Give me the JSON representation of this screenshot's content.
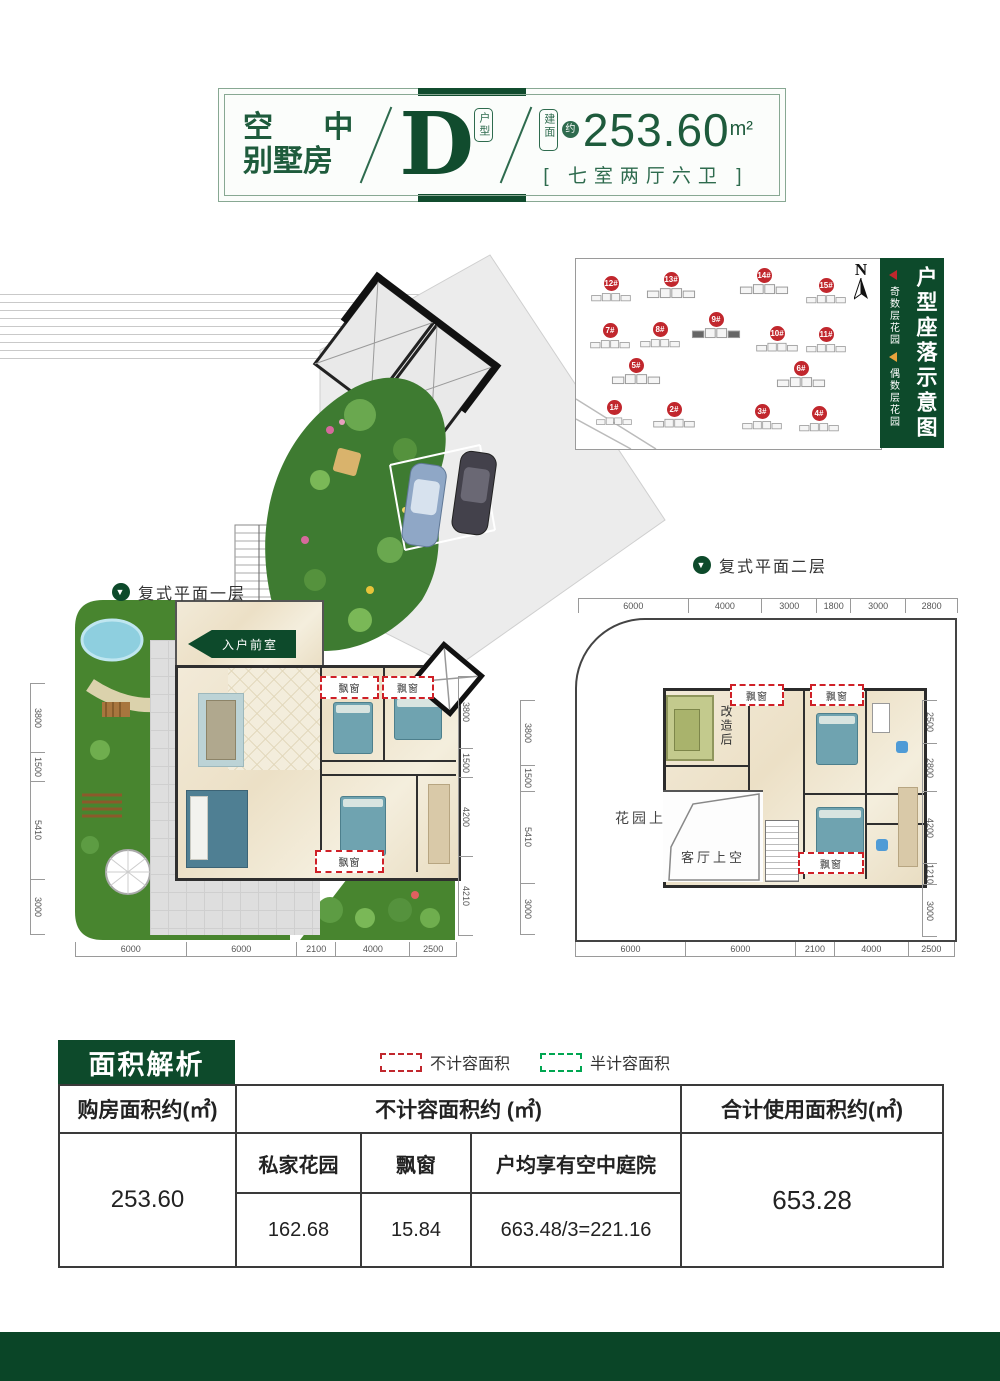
{
  "header": {
    "title_line1": "空 中",
    "title_line2": "别墅房",
    "type_letter": "D",
    "type_badge": "户型",
    "area_badge": "建面",
    "area_approx": "约",
    "area_value": "253.60",
    "area_unit": "m²",
    "layout_text": "[ 七室两厅六卫 ]"
  },
  "site_map": {
    "title": "户型座落示意图",
    "compass": "N",
    "legend_odd": "奇数层花园",
    "legend_even": "偶数层花园",
    "odd_color": "#c1272d",
    "even_color": "#e8a33d",
    "buildings": [
      {
        "id": "12#",
        "x": 35,
        "y": 22,
        "w": 40
      },
      {
        "id": "13#",
        "x": 95,
        "y": 18,
        "w": 58
      },
      {
        "id": "14#",
        "x": 188,
        "y": 14,
        "w": 58
      },
      {
        "id": "15#",
        "x": 250,
        "y": 24,
        "w": 40
      },
      {
        "id": "7#",
        "x": 34,
        "y": 69,
        "w": 40
      },
      {
        "id": "8#",
        "x": 84,
        "y": 68,
        "w": 40
      },
      {
        "id": "9#",
        "x": 140,
        "y": 58,
        "w": 52
      },
      {
        "id": "10#",
        "x": 201,
        "y": 72,
        "w": 42
      },
      {
        "id": "11#",
        "x": 250,
        "y": 73,
        "w": 40
      },
      {
        "id": "5#",
        "x": 60,
        "y": 104,
        "w": 60
      },
      {
        "id": "6#",
        "x": 225,
        "y": 107,
        "w": 58
      },
      {
        "id": "1#",
        "x": 38,
        "y": 146,
        "w": 36
      },
      {
        "id": "2#",
        "x": 98,
        "y": 148,
        "w": 42
      },
      {
        "id": "3#",
        "x": 186,
        "y": 150,
        "w": 40
      },
      {
        "id": "4#",
        "x": 243,
        "y": 152,
        "w": 40
      }
    ]
  },
  "floor1": {
    "label": "复式平面一层",
    "entry_label": "入户前室",
    "bay_window": "飘窗",
    "dims_left": [
      "3800",
      "1500",
      "5410",
      "3000"
    ],
    "dims_right": [
      "3800",
      "1500",
      "4200",
      "4210"
    ],
    "dims_bottom": [
      "6000",
      "6000",
      "2100",
      "4000",
      "2500"
    ]
  },
  "floor2": {
    "label": "复式平面二层",
    "garden_void": "花园上空",
    "living_void": "客厅上空",
    "renovated": "改造后",
    "bay_window": "飘窗",
    "dims_top": [
      "6000",
      "4000",
      "3000",
      "1800",
      "3000",
      "2800"
    ],
    "dims_left": [
      "3800",
      "1500",
      "5410",
      "3000"
    ],
    "dims_right": [
      "2500",
      "2800",
      "4200",
      "1210",
      "3000"
    ],
    "dims_bottom": [
      "6000",
      "6000",
      "2100",
      "4000",
      "2500"
    ]
  },
  "area_table": {
    "title": "面积解析",
    "legend_nojirong": "不计容面积",
    "legend_banjirong": "半计容面积",
    "nojirong_color": "#c1272d",
    "banjirong_color": "#00a651",
    "header_purchase": "购房面积约(㎡)",
    "header_nojirong": "不计容面积约 (㎡)",
    "header_total": "合计使用面积约(㎡)",
    "purchase_value": "253.60",
    "sub_headers": [
      "私家花园",
      "飘窗",
      "户均享有空中庭院"
    ],
    "sub_values": [
      "162.68",
      "15.84",
      "663.48/3=221.16"
    ],
    "total_value": "653.28"
  }
}
